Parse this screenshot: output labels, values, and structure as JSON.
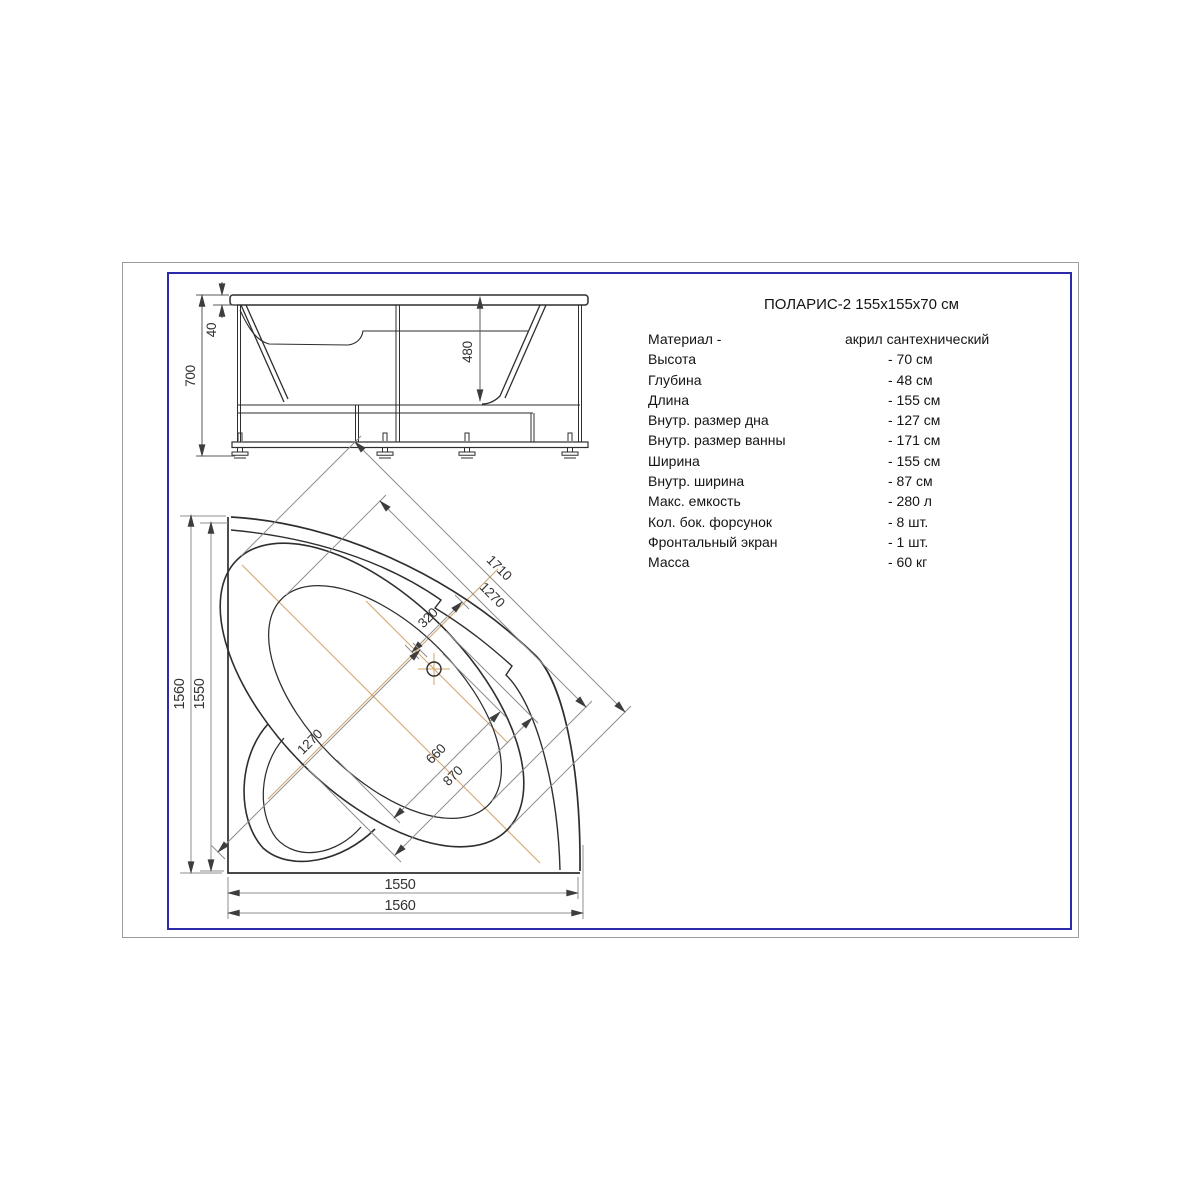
{
  "title": "ПОЛАРИС-2 155x155x70 см",
  "specs": [
    {
      "label": "Материал -",
      "value": "акрил сантехнический"
    },
    {
      "label": "Высота",
      "value": "- 70 см"
    },
    {
      "label": "Глубина",
      "value": "- 48 см"
    },
    {
      "label": "Длина",
      "value": "- 155 см"
    },
    {
      "label": "Внутр. размер дна",
      "value": "- 127 см"
    },
    {
      "label": "Внутр. размер ванны",
      "value": "- 171 см"
    },
    {
      "label": "Ширина",
      "value": "- 155 см"
    },
    {
      "label": "Внутр. ширина",
      "value": "- 87 см"
    },
    {
      "label": "Макс. емкость",
      "value": "- 280 л"
    },
    {
      "label": "Кол. бок. форсунок",
      "value": "- 8 шт."
    },
    {
      "label": "Фронтальный экран",
      "value": "- 1 шт."
    },
    {
      "label": "Масса",
      "value": "- 60 кг"
    }
  ],
  "side_view": {
    "dims": {
      "height_total": "700",
      "rim_height": "40",
      "depth": "480"
    }
  },
  "plan_view": {
    "dims": {
      "left_outer": "1560",
      "left_inner": "1550",
      "bottom_inner": "1550",
      "bottom_outer": "1560",
      "bath_length": "1710",
      "floor_length": "1270",
      "drain_offset": "320",
      "floor_diag": "1270",
      "floor_width": "660",
      "inner_width": "870"
    }
  },
  "colors": {
    "frame_blue": "#2b2baa",
    "frame_gray": "#9b9b9b",
    "line_dark": "#2e2e2e",
    "line_dim": "#8f8f8f",
    "centerline_orange": "#d0a468"
  }
}
